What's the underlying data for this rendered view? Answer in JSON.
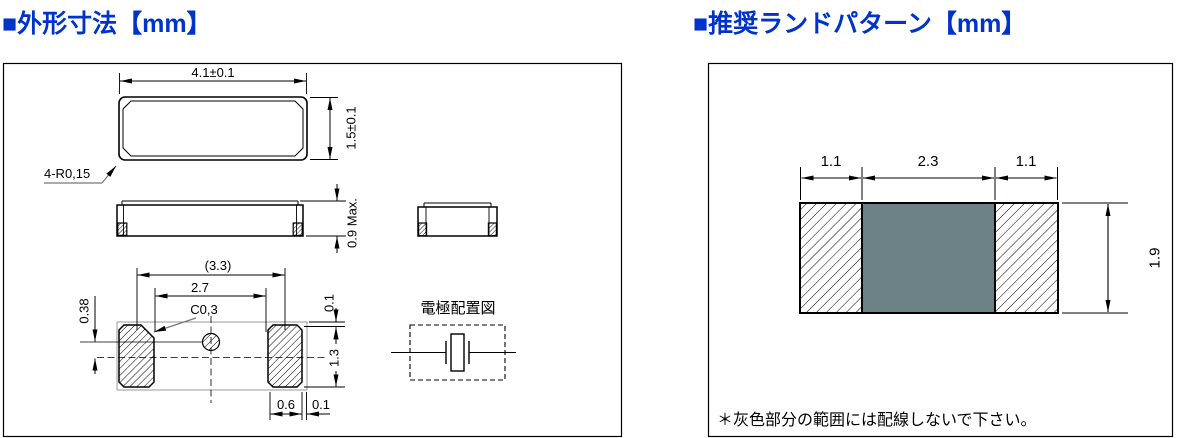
{
  "colors": {
    "header_blue": "#0033cc",
    "keepout_gray": "#6d8287"
  },
  "outline": {
    "title": "■外形寸法【mm】",
    "top_view": {
      "width": "4.1±0.1",
      "height": "1.5±0.1",
      "corner_radius": "4-R0,15"
    },
    "front_view": {
      "height": "0.9 Max."
    },
    "bottom_view": {
      "overall_span": "(3.3)",
      "inner_span": "2.7",
      "chamfer": "C0,3",
      "mark_offset": "0.38",
      "edge_gap_top": "0.1",
      "pad_height": "1.3",
      "pad_width": "0.6",
      "edge_gap_side": "0.1"
    },
    "electrode": {
      "label": "電極配置図"
    }
  },
  "land_pattern": {
    "title": "■推奨ランドパターン【mm】",
    "dims": {
      "left_pad_width": "1.1",
      "center_width": "2.3",
      "right_pad_width": "1.1",
      "height": "1.9"
    },
    "note": "＊灰色部分の範囲には配線しないで下さい。"
  }
}
